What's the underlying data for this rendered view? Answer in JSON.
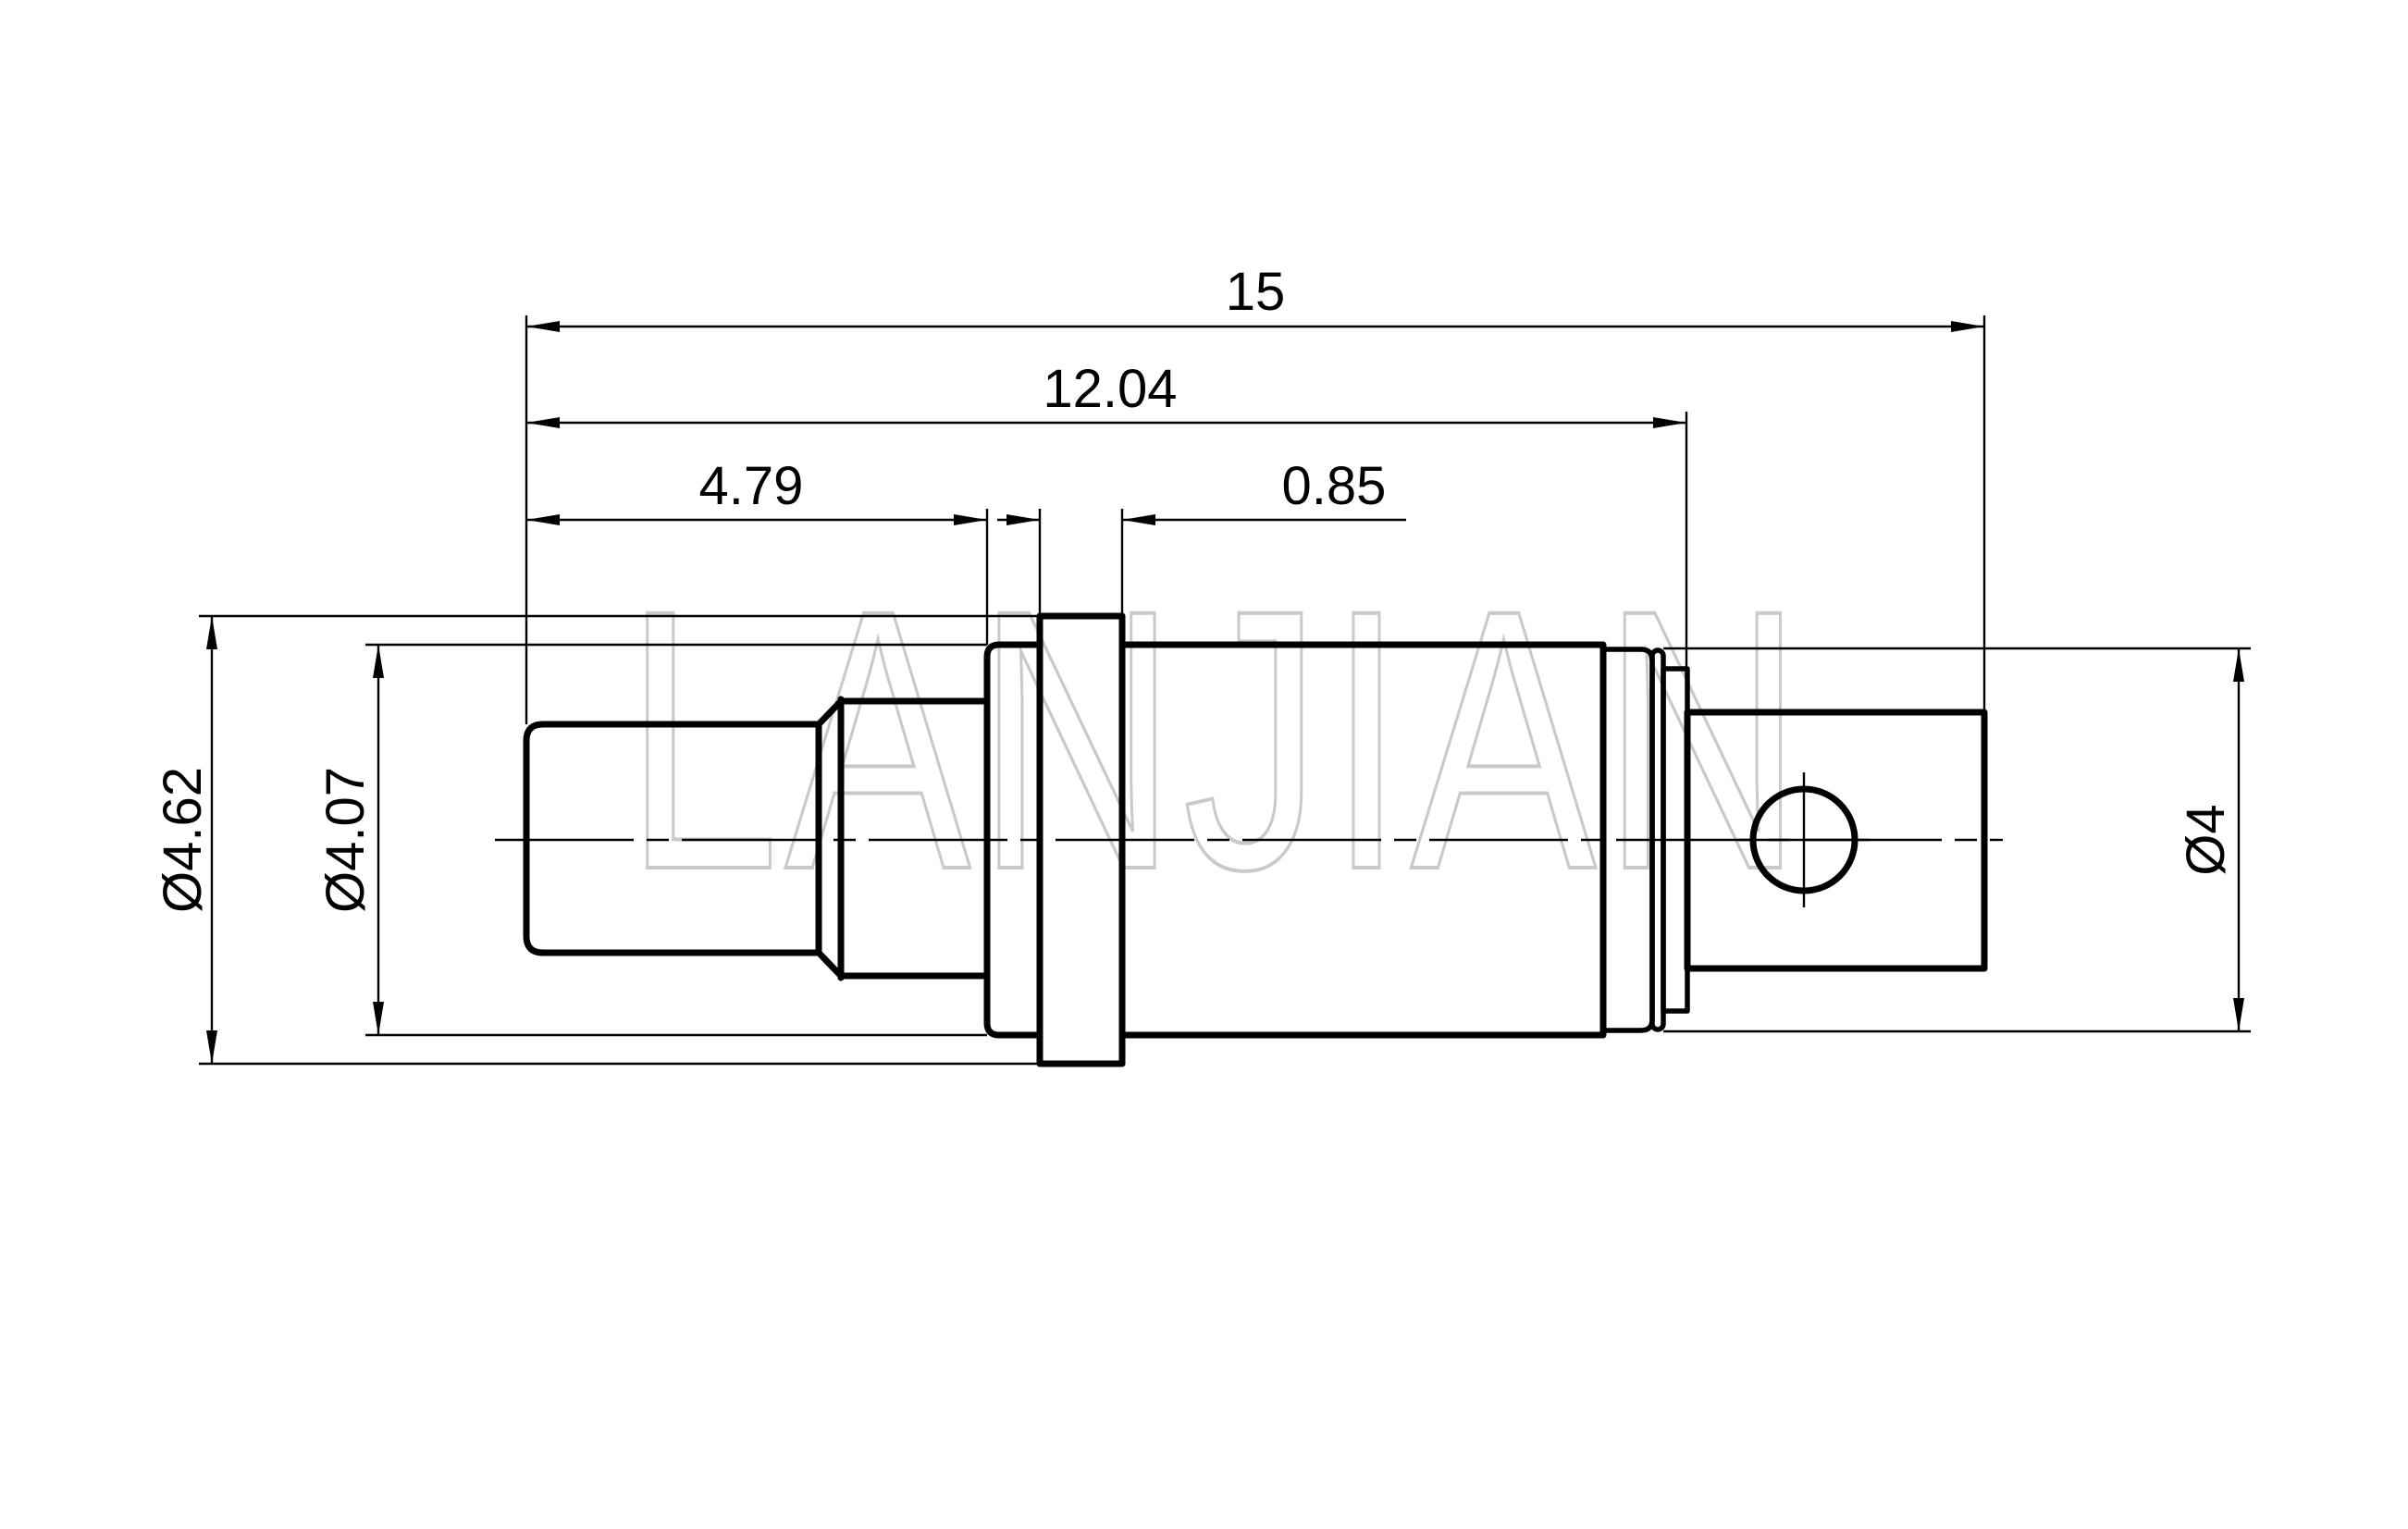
{
  "watermark": {
    "text": "LANJIAN"
  },
  "dimensions": {
    "overall_length": "15",
    "body_length": "12.04",
    "front_length": "4.79",
    "flange_width": "0.85",
    "flange_diameter": "Ø4.62",
    "barrel_diameter": "Ø4.07",
    "ring_diameter": "Ø4"
  },
  "colors": {
    "line": "#000000",
    "watermark": "#c9c9c9",
    "background": "#ffffff"
  }
}
